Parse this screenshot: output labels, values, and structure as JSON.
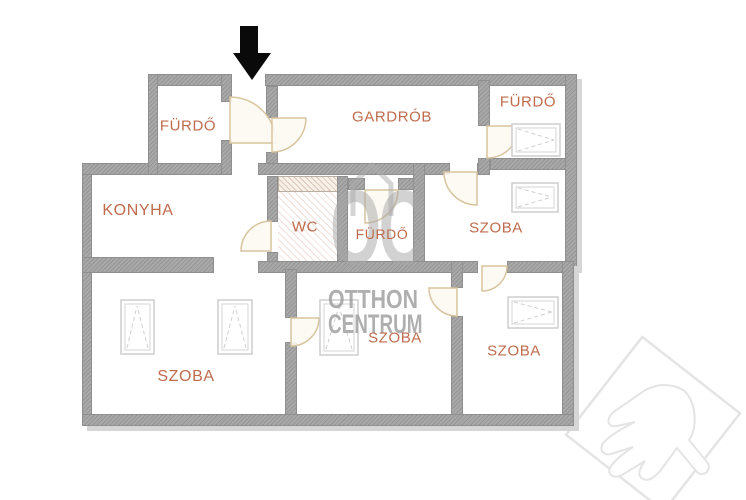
{
  "page": {
    "type": "apartment-floorplan"
  },
  "entrance": {
    "arrow_direction": "down"
  },
  "rooms": [
    {
      "id": "bathroom-top-left",
      "label": "FÜRDŐ"
    },
    {
      "id": "wardrobe",
      "label": "GARDRÓB"
    },
    {
      "id": "bathroom-top-right",
      "label": "FÜRDŐ"
    },
    {
      "id": "kitchen",
      "label": "KONYHA"
    },
    {
      "id": "toilet",
      "label": "WC"
    },
    {
      "id": "bathroom-middle",
      "label": "FÜRDŐ"
    },
    {
      "id": "room-middle-right",
      "label": "SZOBA"
    },
    {
      "id": "room-bottom-left",
      "label": "SZOBA"
    },
    {
      "id": "room-bottom-middle",
      "label": "SZOBA"
    },
    {
      "id": "room-bottom-right",
      "label": "SZOBA"
    }
  ],
  "watermark": {
    "monogram": "OC",
    "line1": "OTTHON",
    "line2": "CENTRUM"
  },
  "colors": {
    "wall": "#a9a9a9",
    "room_label": "#bf6b4c",
    "door_arc": "#d8c49e",
    "watermark": "#9c9c9c",
    "arrow": "#0a0a0a",
    "logo_outline": "#e4e4e4"
  }
}
